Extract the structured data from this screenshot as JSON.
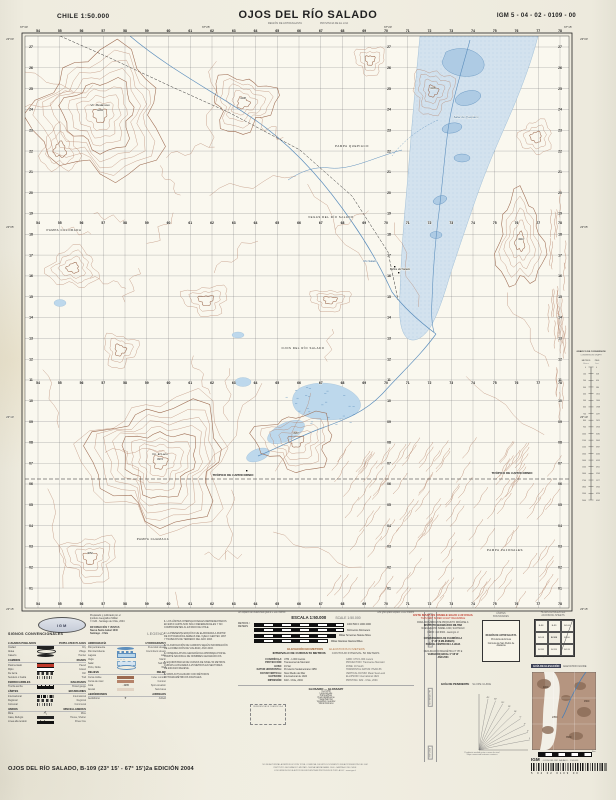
{
  "header": {
    "left": "CHILE  1:50.000",
    "title": "OJOS DEL RÍO SALADO",
    "sub_left": "REGIÓN DE ANTOFAGASTA",
    "sub_right": "PROVINCIA DE EL LOA",
    "right": "IGM 5 - 04 - 02 - 0109 - 00"
  },
  "map": {
    "eastings": [
      54,
      55,
      56,
      57,
      58,
      59,
      60,
      61,
      62,
      63,
      64,
      65,
      66,
      67,
      68,
      69,
      70,
      71,
      72,
      73,
      74,
      75,
      76,
      77,
      78
    ],
    "northings": [
      "27",
      "26",
      "25",
      "24",
      "23",
      "22",
      "21",
      "20",
      "19",
      "18",
      "17",
      "16",
      "15",
      "14",
      "13",
      "12",
      "11",
      "10",
      "09",
      "08",
      "07",
      "06",
      "05",
      "04",
      "03",
      "02",
      "01"
    ],
    "top_lons": [
      "67°30'",
      "67°25'",
      "67°20'",
      "67°15'"
    ],
    "left_lats": [
      "23°00'",
      "23°05'",
      "23°10'",
      "23°15'"
    ],
    "colors": {
      "contour": "#b5836a",
      "contour_dark": "#9c6a50",
      "water": "#5d8fbd",
      "water_fill": "#aecbe4",
      "salar_fill": "#d3e2ee",
      "vega_fill": "#bdd8ec",
      "grid": "#77777a",
      "paper": "#faf8ef"
    },
    "labels": [
      {
        "t": "Vn. Medanoso",
        "x": 100,
        "y": 106,
        "s": 3,
        "i": 1
      },
      {
        "t": "4265",
        "x": 100,
        "y": 111,
        "s": 2.7
      },
      {
        "t": "4138",
        "x": 243,
        "y": 99,
        "s": 2.6
      },
      {
        "t": "PAMPA COLORADA",
        "x": 64,
        "y": 231,
        "s": 2.9,
        "ls": 1
      },
      {
        "t": "PAMPA QUEPIACO",
        "x": 352,
        "y": 147,
        "s": 2.9,
        "ls": 1
      },
      {
        "t": "Salar de Quepiaco",
        "x": 466,
        "y": 118,
        "s": 3,
        "i": 1,
        "c": "#3f6fa0"
      },
      {
        "t": "VEGAS DEL RÍO SALADO",
        "x": 331,
        "y": 218,
        "s": 2.8,
        "ls": 1
      },
      {
        "t": "OJOS DEL RÍO SALADO",
        "x": 303,
        "y": 349,
        "s": 2.8,
        "ls": 1
      },
      {
        "t": "Río Salado",
        "x": 370,
        "y": 262,
        "s": 2.7,
        "i": 1,
        "c": "#3f6fa0"
      },
      {
        "t": "Baños del Salado",
        "x": 400,
        "y": 270,
        "s": 2.6,
        "i": 1
      },
      {
        "t": "TRÓPICO DE CAPRICORNIO",
        "x": 233,
        "y": 476,
        "s": 3,
        "b": 1
      },
      {
        "t": "TRÓPICO DE CAPRICORNIO",
        "x": 512,
        "y": 474,
        "s": 3,
        "b": 1
      },
      {
        "t": "PAMPA CHAMACA",
        "x": 153,
        "y": 540,
        "s": 2.9,
        "ls": 1
      },
      {
        "t": "PAMPA PAJONALES",
        "x": 505,
        "y": 551,
        "s": 2.9,
        "ls": 1
      },
      {
        "t": "Co. El Laco",
        "x": 160,
        "y": 455,
        "s": 3,
        "i": 1
      },
      {
        "t": "4972",
        "x": 160,
        "y": 460,
        "s": 2.7
      },
      {
        "t": "4105",
        "x": 433,
        "y": 89,
        "s": 2.6
      },
      {
        "t": "4310",
        "x": 521,
        "y": 240,
        "s": 2.6
      },
      {
        "t": "3987",
        "x": 296,
        "y": 434,
        "s": 2.6
      },
      {
        "t": "4052",
        "x": 90,
        "y": 554,
        "s": 2.6
      }
    ]
  },
  "conversion": {
    "title1": "GRÁFICO DE CONVERSIÓN",
    "title2": "CONVERSION GRAPH",
    "u_left": "METROS",
    "u_right": "PIES",
    "u_left2": "Meters",
    "u_right2": "Feet"
  },
  "credits1": [
    "Preparado y publicado por el",
    "Instituto Geográfico Militar",
    "© IGM - Santiago de Chile, 2004"
  ],
  "credits2": [
    "INFORMACIÓN Y VENTAS",
    "Nueva Santa Isabel 1640",
    "Santiago - Chile"
  ],
  "logo": "IGM",
  "legend": {
    "title": "SIGNOS CONVENCIONALES",
    "title_en": "LEGEND",
    "colA": [
      {
        "hes": "LUGARES POBLADOS",
        "hen": "POPULATED PLACES"
      },
      {
        "es": "Ciudad",
        "en": "City",
        "sw": "s-town"
      },
      {
        "es": "Aldea",
        "en": "Village",
        "sw": "s-dot"
      },
      {
        "es": "Caserío",
        "en": "Hamlet",
        "sw": "s-dot2"
      },
      {
        "hes": "CAMINOS",
        "hen": "ROADS"
      },
      {
        "es": "Pavimentado",
        "en": "Paved",
        "sw": "s-road"
      },
      {
        "es": "Ripio",
        "en": "Gravel",
        "sw": "s-road2"
      },
      {
        "es": "De tierra",
        "en": "Dirt",
        "sw": "s-dash"
      },
      {
        "es": "Sendero o huella",
        "en": "Trail",
        "sw": "s-dots"
      },
      {
        "hes": "FERROCARRILES",
        "hen": "RAILROADS"
      },
      {
        "es": "Trocha ancha",
        "en": "Broad gauge",
        "sw": "s-rr"
      },
      {
        "hes": "LÍMITES",
        "hen": "BOUNDARIES"
      },
      {
        "es": "Internacional",
        "en": "International",
        "sw": "s-intl"
      },
      {
        "es": "Regional",
        "en": "Regional",
        "sw": "s-dash"
      },
      {
        "es": "Comunal",
        "en": "Communal",
        "sw": "s-dots"
      },
      {
        "hes": "VARIOS",
        "hen": "MISCELLANEOUS"
      },
      {
        "es": "Mina",
        "en": "Mine",
        "sw": "s-mine",
        "glyph": "⛏"
      },
      {
        "es": "Casa, Refugio",
        "en": "House, Shelter",
        "sw": "s-sq"
      },
      {
        "es": "Línea alta tensión",
        "en": "Power line",
        "sw": "s-power"
      }
    ],
    "colB": [
      {
        "hes": "HIDROGRAFÍA",
        "hen": "HYDROGRAPHY"
      },
      {
        "es": "Río permanente",
        "en": "Perennial stream",
        "sw": "s-blue"
      },
      {
        "es": "Río intermitente",
        "en": "Intermittent stream",
        "sw": "s-bluedash"
      },
      {
        "es": "Laguna",
        "en": "Lake",
        "sw": "s-lake"
      },
      {
        "es": "Vega",
        "en": "Marsh",
        "sw": "s-marsh",
        "glyph": "⌣⌣⌣"
      },
      {
        "es": "Salar",
        "en": "Salt flat",
        "sw": "s-salar"
      },
      {
        "es": "Pozo, Noria",
        "en": "Well",
        "sw": "s-circ"
      },
      {
        "hes": "RELIEVE",
        "hen": "RELIEF"
      },
      {
        "es": "Curva índice",
        "en": "Index contour",
        "sw": "s-line2"
      },
      {
        "es": "Curva de nivel",
        "en": "Contour",
        "sw": "s-line"
      },
      {
        "es": "Cota",
        "en": "Spot elevation",
        "sw": "s-spot",
        "glyph": "· 4265"
      },
      {
        "es": "Arenal",
        "en": "Sand area",
        "sw": "s-sand"
      },
      {
        "hes": "AERÓDROMOS",
        "hen": "AIRFIELDS"
      },
      {
        "es": "Aeródromo",
        "en": "Airfield",
        "sw": "s-mine",
        "glyph": "✈"
      }
    ]
  },
  "notes": [
    {
      "n": "1.",
      "lines": [
        "LOS LÍMITES INTERNACIONALES REPRESENTADOS",
        "EN ESTA CARTA SON SÓLO REFERENCIALES Y NO",
        "COMPROMETEN AL ESTADO DE CHILE."
      ]
    },
    {
      "n": "2.",
      "lines": [
        "LA PRESENTE EDICIÓN FUE ELABORADA A PARTIR",
        "DE FOTOGRAFÍAS AÉREAS DEL VUELO GEOTEC 1997",
        "Y TRABAJOS DE TERRENO DEL AÑO 2003."
      ]
    },
    {
      "n": "3.",
      "lines": [
        "CLASIFICACIÓN DE CAMINOS SEGÚN INFORMACIÓN",
        "DE LA DIRECCIÓN DE VIALIDAD, AÑO 2003."
      ]
    },
    {
      "n": "4.",
      "lines": [
        "NOMENCLATURA GEOGRÁFICA APROBADA POR EL",
        "COMITÉ NACIONAL DE NOMBRES GEOGRÁFICOS."
      ]
    },
    {
      "n": "5.",
      "lines": [
        "EQUIDISTANCIA DE CURVAS DE NIVEL 50 METROS.",
        "CURVAS AUXILIARES A 25 METROS EN SECTORES",
        "DE ESCASO RELIEVE."
      ]
    },
    {
      "n": "6.",
      "lines": [
        "MAPA ACTUALIZADO CON MÉTODOS",
        "FOTOGRAMÉTRICOS DIGITALES."
      ]
    }
  ],
  "scale": {
    "note_es": "Un espacio de cuadrícula igual a 1.000 metros",
    "note_en": "One grid space equals 1.000 meters",
    "escala": "ESCALA 1:50.000",
    "scale_en": "SCALE 1:50.000",
    "metros": "METROS",
    "meters": "METERS",
    "bars": [
      [
        "Kilómetros",
        "Kilometers"
      ],
      [
        "Millas Terrestres",
        "Statute Miles"
      ],
      [
        "Millas Náuticas",
        "Nautical Miles"
      ]
    ],
    "elev_es": "ELEVACIÓN EN METROS",
    "elev_en": "ELEVATIONS IN METERS",
    "int_es": "INTERVALO DE CURVAS 50 METROS",
    "int_en": "CONTOUR INTERVAL 50 METERS"
  },
  "refs": [
    [
      "CUADRÍCULA:",
      "UTM - 1.000 metros",
      "GRID: UTM 1.000 meters"
    ],
    [
      "PROYECCIÓN:",
      "Transversal de Mercator",
      "PROJECTION: Transverse Mercator"
    ],
    [
      "HUSO:",
      "19 Sur",
      "ZONE: 19 South"
    ],
    [
      "DATUM HORIZONTAL:",
      "Provisorio Sudamericano 1956",
      "HORIZONTAL DATUM: PSAD-56"
    ],
    [
      "DATUM VERTICAL:",
      "Nivel Medio del Mar",
      "VERTICAL DATUM: Mean Sea Level"
    ],
    [
      "ELIPSOIDE:",
      "Internacional de 1924",
      "ELLIPSOID: International 1924"
    ],
    [
      "IMPRESIÓN:",
      "IGM - Chile, 2004",
      "PRINTING: IGM - Chile, 2004"
    ]
  ],
  "glossary": {
    "title": "GLOSARIO — GLOSSARY",
    "ref_note": "REFERENCIA DE CUADRÍCULA",
    "rows": [
      [
        "Cerro",
        "Hill"
      ],
      [
        "Laguna",
        "Lake"
      ],
      [
        "Pampa",
        "Plain"
      ],
      [
        "Quebrada",
        "Ravine"
      ],
      [
        "Salar",
        "Salt flat"
      ],
      [
        "Vega",
        "Wet meadow"
      ],
      [
        "Volcán",
        "Volcano"
      ]
    ]
  },
  "vstrip": [
    "CARTA NACIONAL DE CHILE",
    "SISTEMA UTM",
    "IGM 2004"
  ],
  "red_notice": {
    "es": "ESTE MAPA ES VISIBLE BAJO LUZ ROJA",
    "en": "THIS MAP IS RED LIGHT READABLE"
  },
  "conv_lines": [
    "PARA ADQUIRIR ESTE PRODUCTO DIRÍJASE A:",
    "INSTITUTO GEOGRÁFICO MILITAR",
    "NUEVA SANTA ISABEL 1640, SANTIAGO",
    "FONO: 410 9300 - www.igm.cl",
    "",
    "CONVERGENCIA DE CUADRÍCULA",
    "0° 28' (8 MILÉSIMAS)",
    "PARA EL CENTRO DE LA HOJA",
    "",
    "DECLINACIÓN MAGNÉTICA 3° 05' E",
    "VARIACIÓN ANUAL 0° 08' W",
    "AÑO 2004"
  ],
  "slope": {
    "es": "GUÍA DE PENDIENTE",
    "en": "SLOPE GUIDE",
    "degrees": [
      "45°",
      "30°",
      "20°",
      "15°",
      "10°",
      "5°",
      "3°",
      "2°",
      "1°"
    ],
    "notes": [
      "Pendiente medida entre curvas de nivel",
      "Slope measured between contours"
    ]
  },
  "limits": {
    "es": "LÍMITES",
    "en": "BOUNDARIES",
    "lines": [
      "REGIÓN DE ANTOFAGASTA",
      "Provincia de El Loa",
      "Comuna de San Pedro de Atacama"
    ]
  },
  "adjoining": {
    "es": "HOJAS ADYACENTES",
    "en": "ADJOINING SHEETS",
    "cells": [
      "B-98",
      "B-99",
      "B-100",
      "B-108",
      "B-109",
      "B-110",
      "B-118",
      "B-119",
      "B-120"
    ],
    "note": "Hojas adyacentes en índice IGM 1:50.000"
  },
  "elevation_guide": {
    "es": "GUÍA DE ELEVACIÓN",
    "en": "ELEVATION GUIDE",
    "bar_label": "Km",
    "labels": [
      {
        "t": "4000",
        "x": 11,
        "y": 16
      },
      {
        "t": "4500",
        "x": 52,
        "y": 30
      },
      {
        "t": "2350",
        "x": 20,
        "y": 46
      },
      {
        "t": "3500",
        "x": 34,
        "y": 66
      }
    ]
  },
  "footer": {
    "left": "OJOS DEL RÍO SALADO, B-109 (23° 15' - 67° 15')2a EDICIÓN 2004",
    "center_lines": [
      "NO SE AUTORIZA LA REPRODUCCIÓN TOTAL O PARCIAL DE ESTE DOCUMENTO SIN AUTORIZACIÓN DEL IGM",
      "INSTITUTO GEOGRÁFICO MILITAR - NUEVA SANTA ISABEL 1640 - SANTIAGO DE CHILE",
      "LOS DERECHOS DE AUTOR SE ENCUENTRAN PROTEGIDOS POR LA LEY - www.igm.cl"
    ],
    "barcode": {
      "brand": "IGM",
      "code": "- OJOS DEL RÍO SALADO - 1:50.000",
      "digits": "5  04  02  0109  00"
    }
  }
}
